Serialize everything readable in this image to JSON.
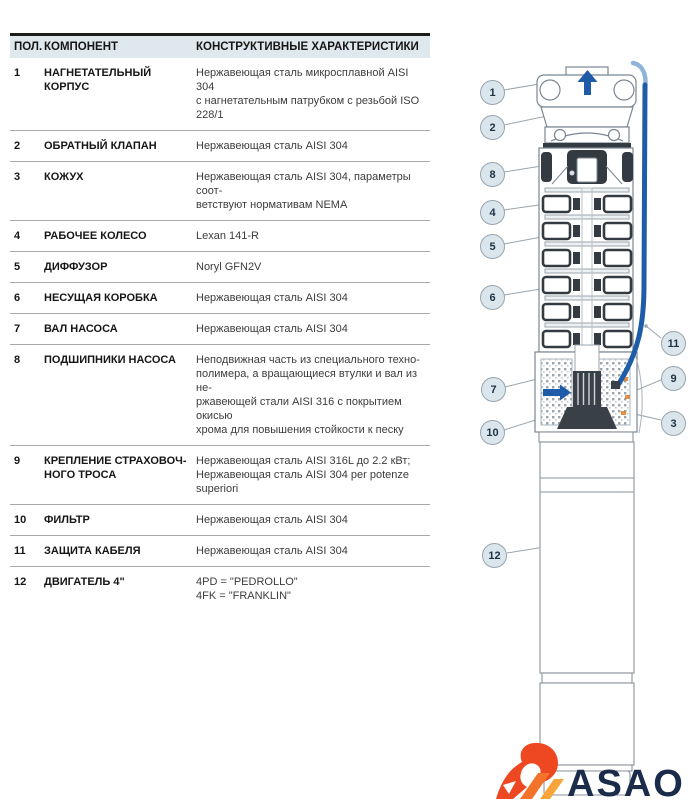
{
  "table": {
    "headers": {
      "pos": "ПОЛ.",
      "component": "КОМПОНЕНТ",
      "characteristics": "КОНСТРУКТИВНЫЕ ХАРАКТЕРИСТИКИ"
    },
    "rows": [
      {
        "pos": "1",
        "component": "НАГНЕТАТЕЛЬНЫЙ КОРПУС",
        "characteristics": "Нержавеющая сталь микросплавной AISI 304\nс нагнетательным патрубком с резьбой ISO\n228/1"
      },
      {
        "pos": "2",
        "component": "ОБРАТНЫЙ КЛАПАН",
        "characteristics": "Нержавеющая сталь AISI 304"
      },
      {
        "pos": "3",
        "component": "КОЖУХ",
        "characteristics": "Нержавеющая сталь AISI 304, параметры соот-\nветствуют нормативам NEMA"
      },
      {
        "pos": "4",
        "component": "РАБОЧЕЕ КОЛЕСО",
        "characteristics": "Lexan 141-R"
      },
      {
        "pos": "5",
        "component": "ДИФФУЗОР",
        "characteristics": "Noryl GFN2V"
      },
      {
        "pos": "6",
        "component": "НЕСУЩАЯ КОРОБКА",
        "characteristics": "Нержавеющая сталь AISI 304"
      },
      {
        "pos": "7",
        "component": "ВАЛ НАСОСА",
        "characteristics": "Нержавеющая сталь AISI 304"
      },
      {
        "pos": "8",
        "component": "ПОДШИПНИКИ НАСОСА",
        "characteristics": "Неподвижная часть из специального техно-\nполимера, а вращающиеся втулки и вал из не-\nржавеющей стали AISI 316 с покрытием окисью\nхрома для повышения стойкости к песку"
      },
      {
        "pos": "9",
        "component": "КРЕПЛЕНИЕ СТРАХОВОЧ-\nНОГО ТРОСА",
        "characteristics": "Нержавеющая сталь AISI 316L до 2.2 кВт;\nНержавеющая сталь AISI 304 per potenze\nsuperiori"
      },
      {
        "pos": "10",
        "component": "ФИЛЬТР",
        "characteristics": "Нержавеющая сталь AISI 304"
      },
      {
        "pos": "11",
        "component": "ЗАЩИТА КАБЕЛЯ",
        "characteristics": "Нержавеющая сталь AISI 304"
      },
      {
        "pos": "12",
        "component": "ДВИГАТЕЛЬ 4\"",
        "characteristics": "4PD = \"PEDROLLO\"\n4FK = \"FRANKLIN\""
      }
    ]
  },
  "diagram": {
    "callouts": [
      {
        "label": "1"
      },
      {
        "label": "2"
      },
      {
        "label": "3"
      },
      {
        "label": "4"
      },
      {
        "label": "5"
      },
      {
        "label": "6"
      },
      {
        "label": "7"
      },
      {
        "label": "8"
      },
      {
        "label": "9"
      },
      {
        "label": "10"
      },
      {
        "label": "11"
      },
      {
        "label": "12"
      }
    ]
  },
  "logo": {
    "text": "ASAO"
  },
  "colors": {
    "accent_blue": "#1e5ca8",
    "table_header_bg": "#dfe8ec",
    "callout_fill": "#dbe5ec",
    "logo_navy": "#1b2b4a",
    "logo_orange": "#ee4823",
    "logo_amber": "#f9a53a"
  }
}
